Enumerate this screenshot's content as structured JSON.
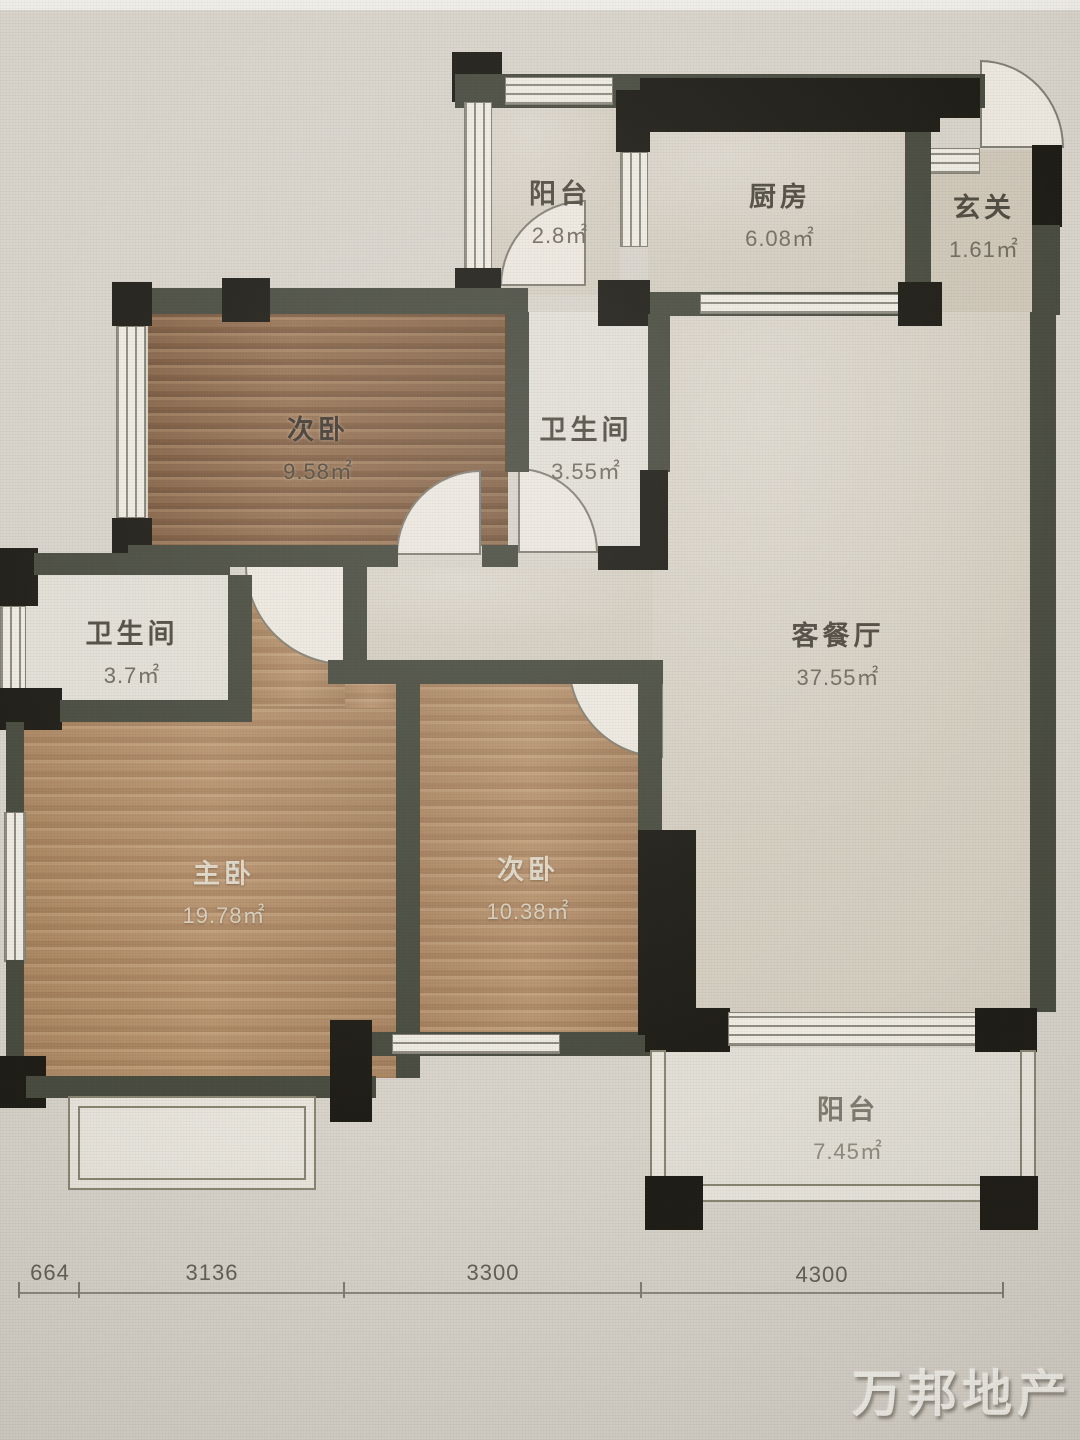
{
  "rooms": [
    {
      "name": "阳台",
      "area": "2.8㎡"
    },
    {
      "name": "厨房",
      "area": "6.08㎡"
    },
    {
      "name": "玄关",
      "area": "1.61㎡"
    },
    {
      "name": "次卧",
      "area": "9.58㎡"
    },
    {
      "name": "卫生间",
      "area": "3.55㎡"
    },
    {
      "name": "卫生间",
      "area": "3.7㎡"
    },
    {
      "name": "客餐厅",
      "area": "37.55㎡"
    },
    {
      "name": "主卧",
      "area": "19.78㎡"
    },
    {
      "name": "次卧",
      "area": "10.38㎡"
    },
    {
      "name": "阳台",
      "area": "7.45㎡"
    }
  ],
  "dimensions": [
    "664",
    "3136",
    "3300",
    "4300"
  ],
  "watermark": "万邦地产",
  "colors": {
    "wall_black": "#17160f",
    "wall_gray": "#43463a",
    "floor_tile": "#d2ccbf",
    "floor_wood": "#b68f68"
  }
}
